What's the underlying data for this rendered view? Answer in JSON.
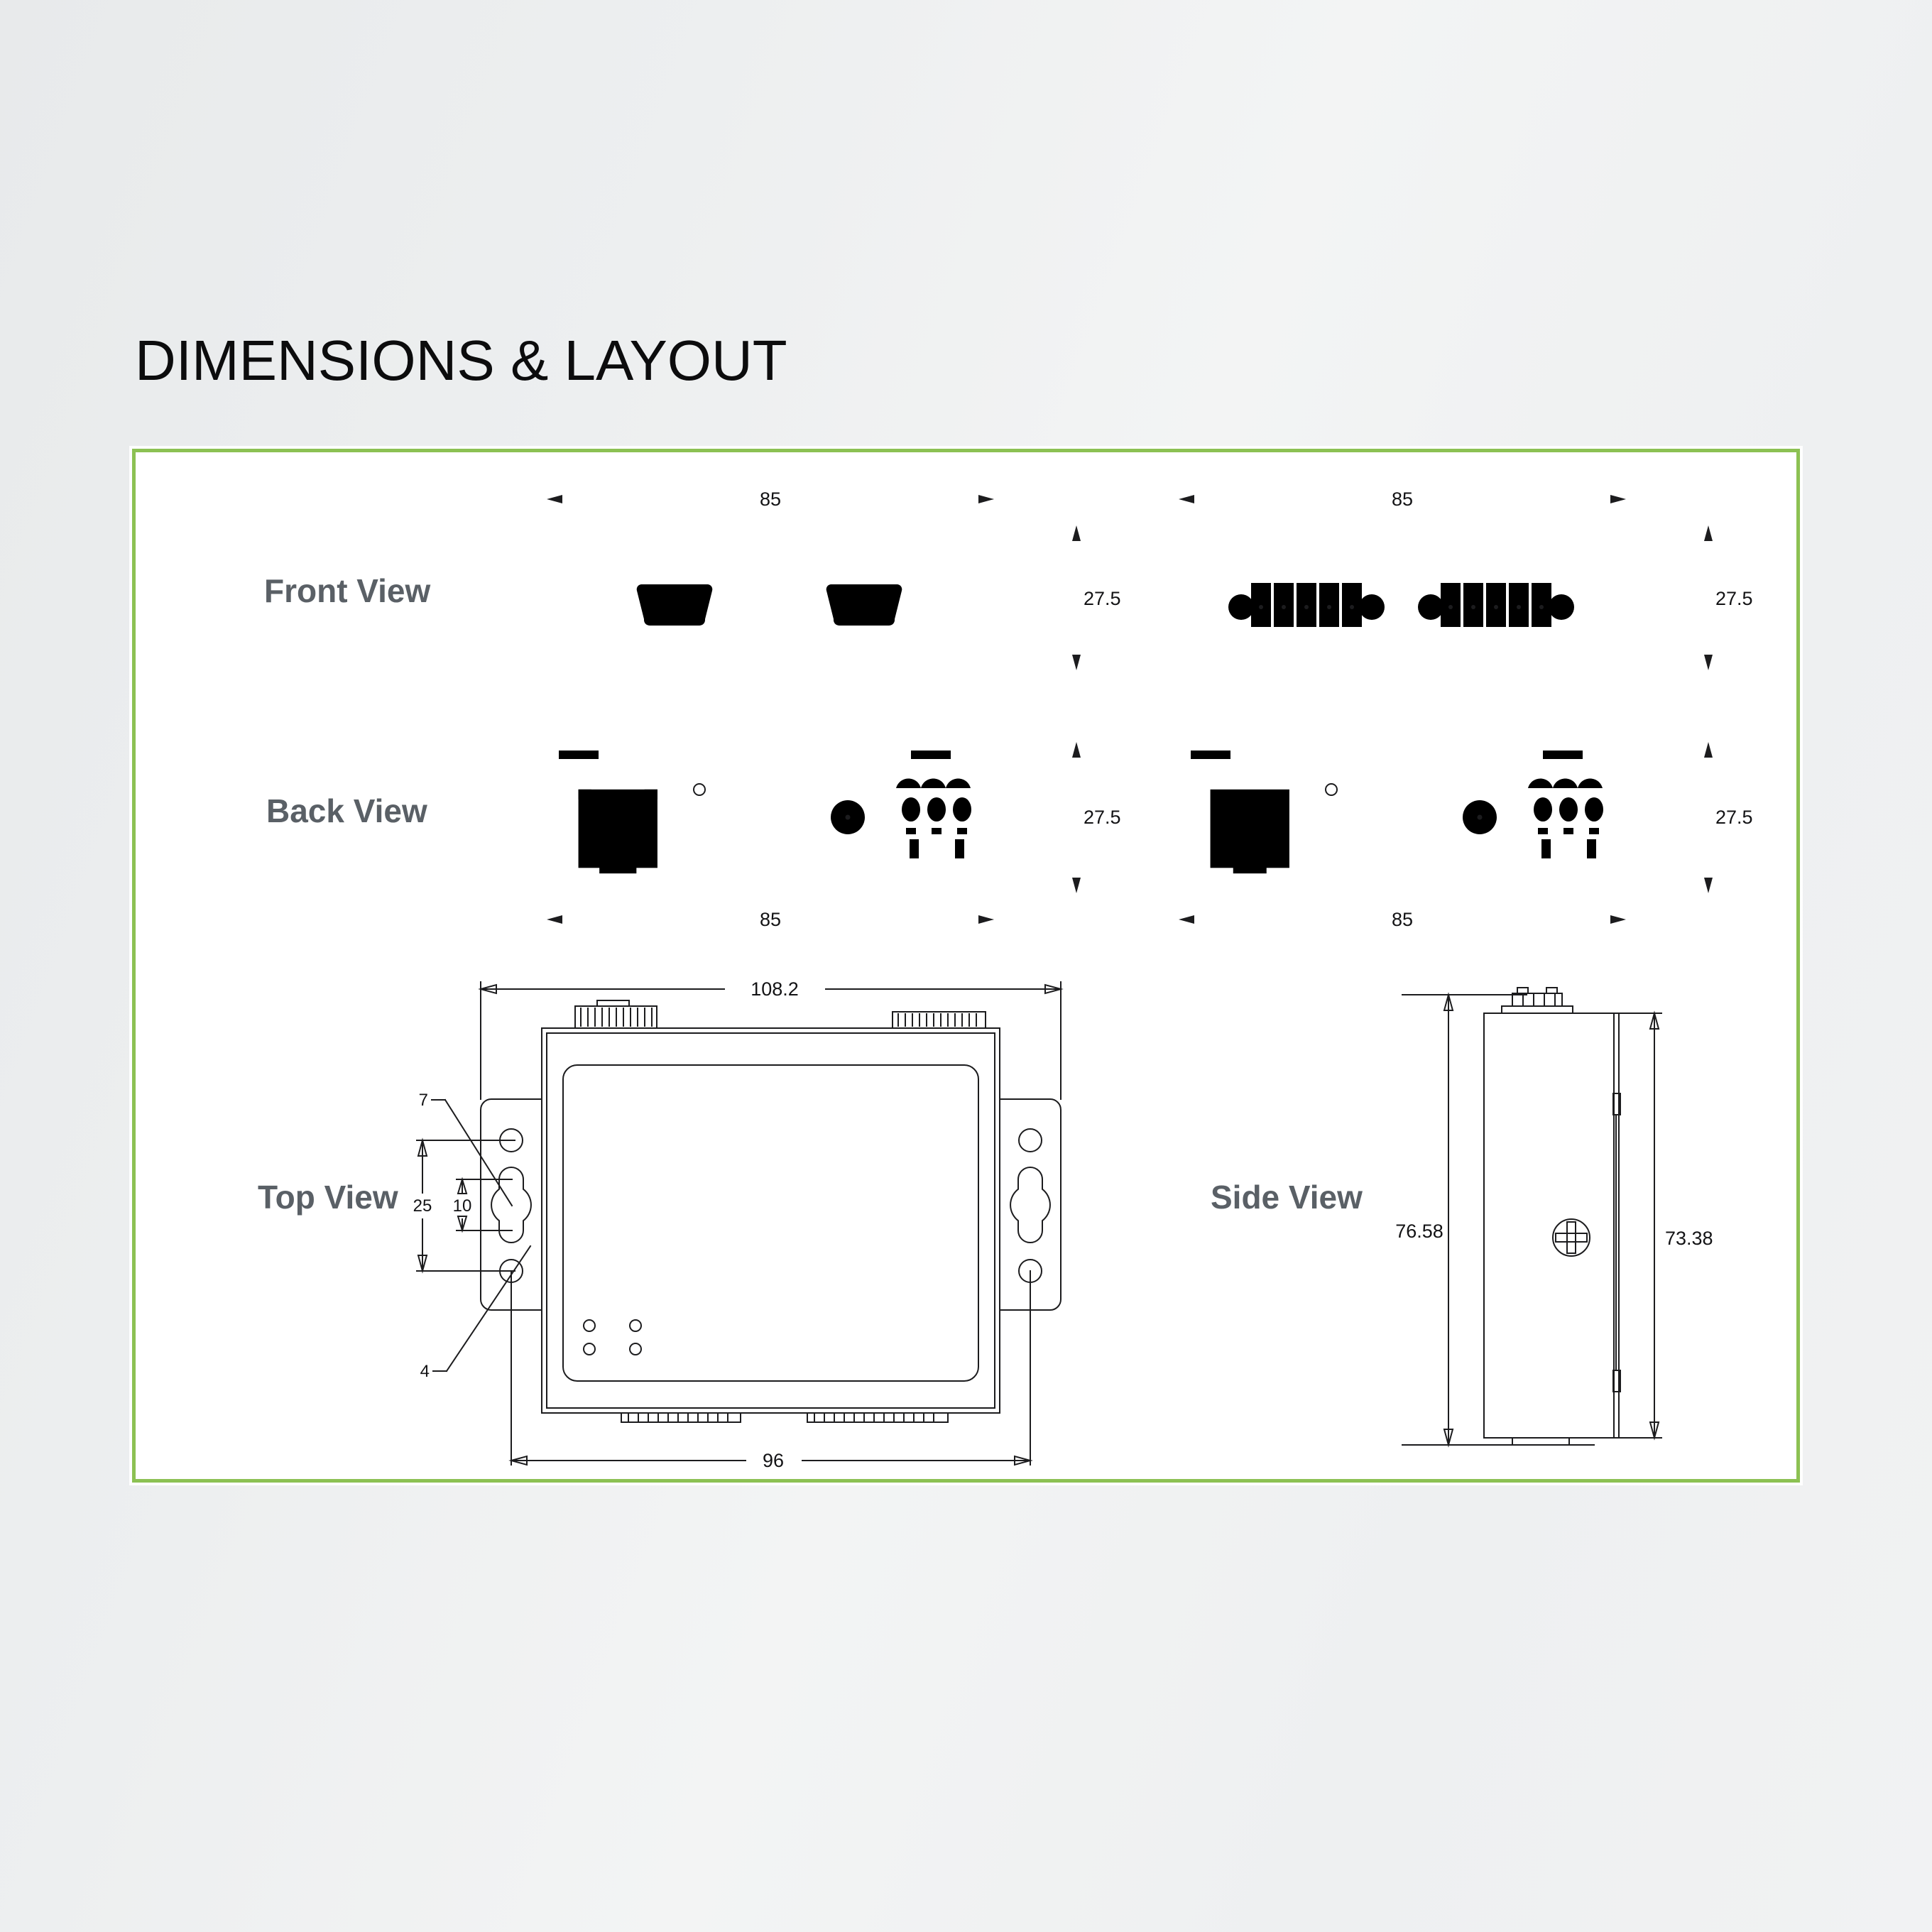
{
  "title": "DIMENSIONS & LAYOUT",
  "panel": {
    "border_color": "#8cc153",
    "background": "#ffffff"
  },
  "views": {
    "front": {
      "label": "Front View",
      "serial": {
        "width": "85",
        "height": "27.5"
      },
      "terminal": {
        "width": "85",
        "height": "27.5"
      }
    },
    "back": {
      "label": "Back View",
      "serial": {
        "width": "85",
        "height": "27.5"
      },
      "terminal": {
        "width": "85",
        "height": "27.5"
      }
    },
    "top": {
      "label": "Top View",
      "overall_width": "108.2",
      "mount_hole_span": "96",
      "hole_pitch": "25",
      "slot_length": "10",
      "slot_width": "7",
      "hole_diameter": "4"
    },
    "side": {
      "label": "Side View",
      "overall_height": "76.58",
      "body_height": "73.38"
    }
  }
}
